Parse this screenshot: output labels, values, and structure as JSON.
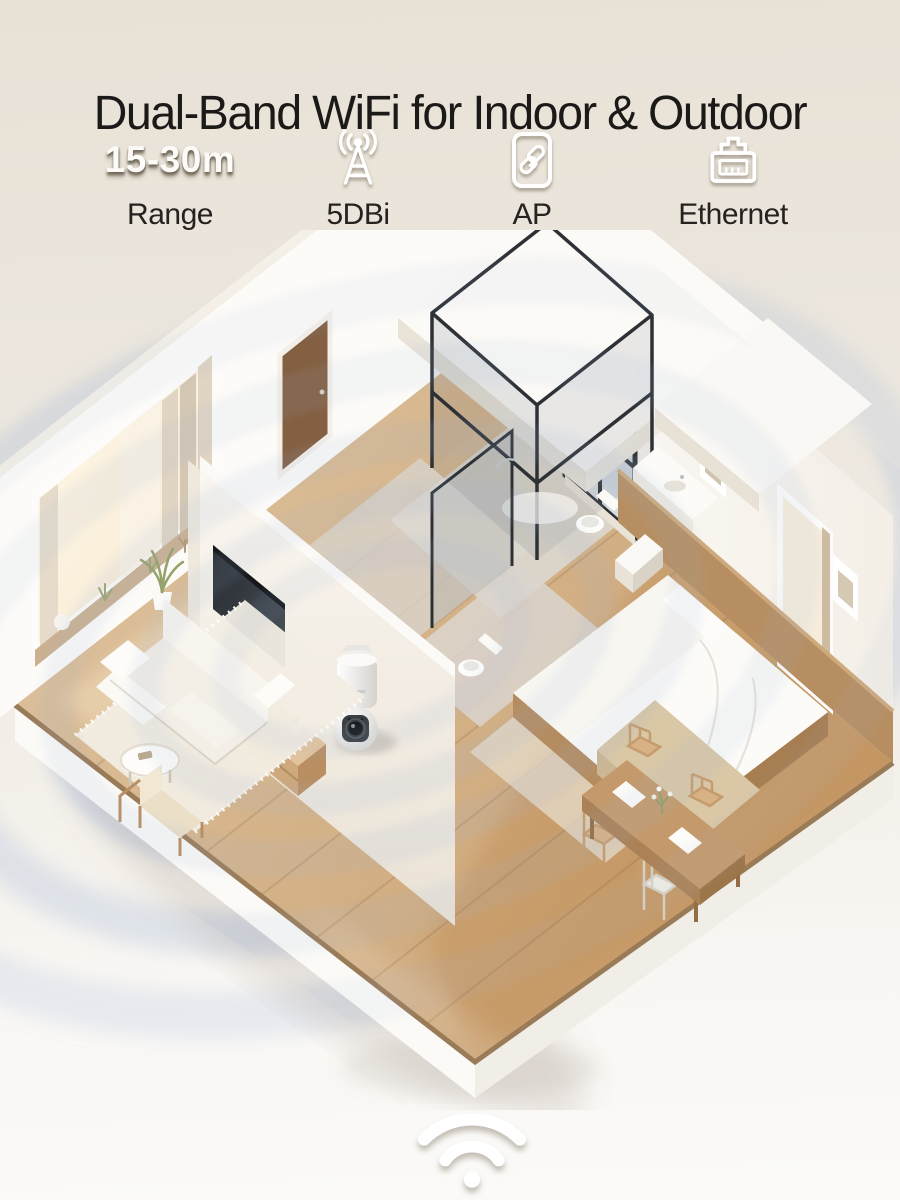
{
  "header": {
    "title": "Dual-Band WiFi for Indoor & Outdoor"
  },
  "features": [
    {
      "value": "15-30m",
      "label": "Range",
      "icon": "range-text-badge"
    },
    {
      "label": "5DBi",
      "icon": "antenna-icon"
    },
    {
      "label": "AP",
      "icon": "ap-link-icon"
    },
    {
      "label": "Ethernet",
      "icon": "ethernet-port-icon"
    }
  ],
  "scene": {
    "illustration": "isometric-apartment-floorplan",
    "device": "wall-mounted pan-tilt wifi security camera",
    "effects": [
      "wifi-signal-ripples"
    ]
  },
  "footer": {
    "icon": "wifi-icon"
  },
  "colors": {
    "background_top": "#e7e1d6",
    "background_bottom": "#fbfaf8",
    "title_text": "#1b1a18",
    "label_text": "#242320",
    "feature_glyph": "#ffffff",
    "signal_ripple": "#9cb3d6",
    "wood_floor": "#cda57a",
    "wall_white": "#ffffff",
    "glass_frame": "#2d3136"
  }
}
